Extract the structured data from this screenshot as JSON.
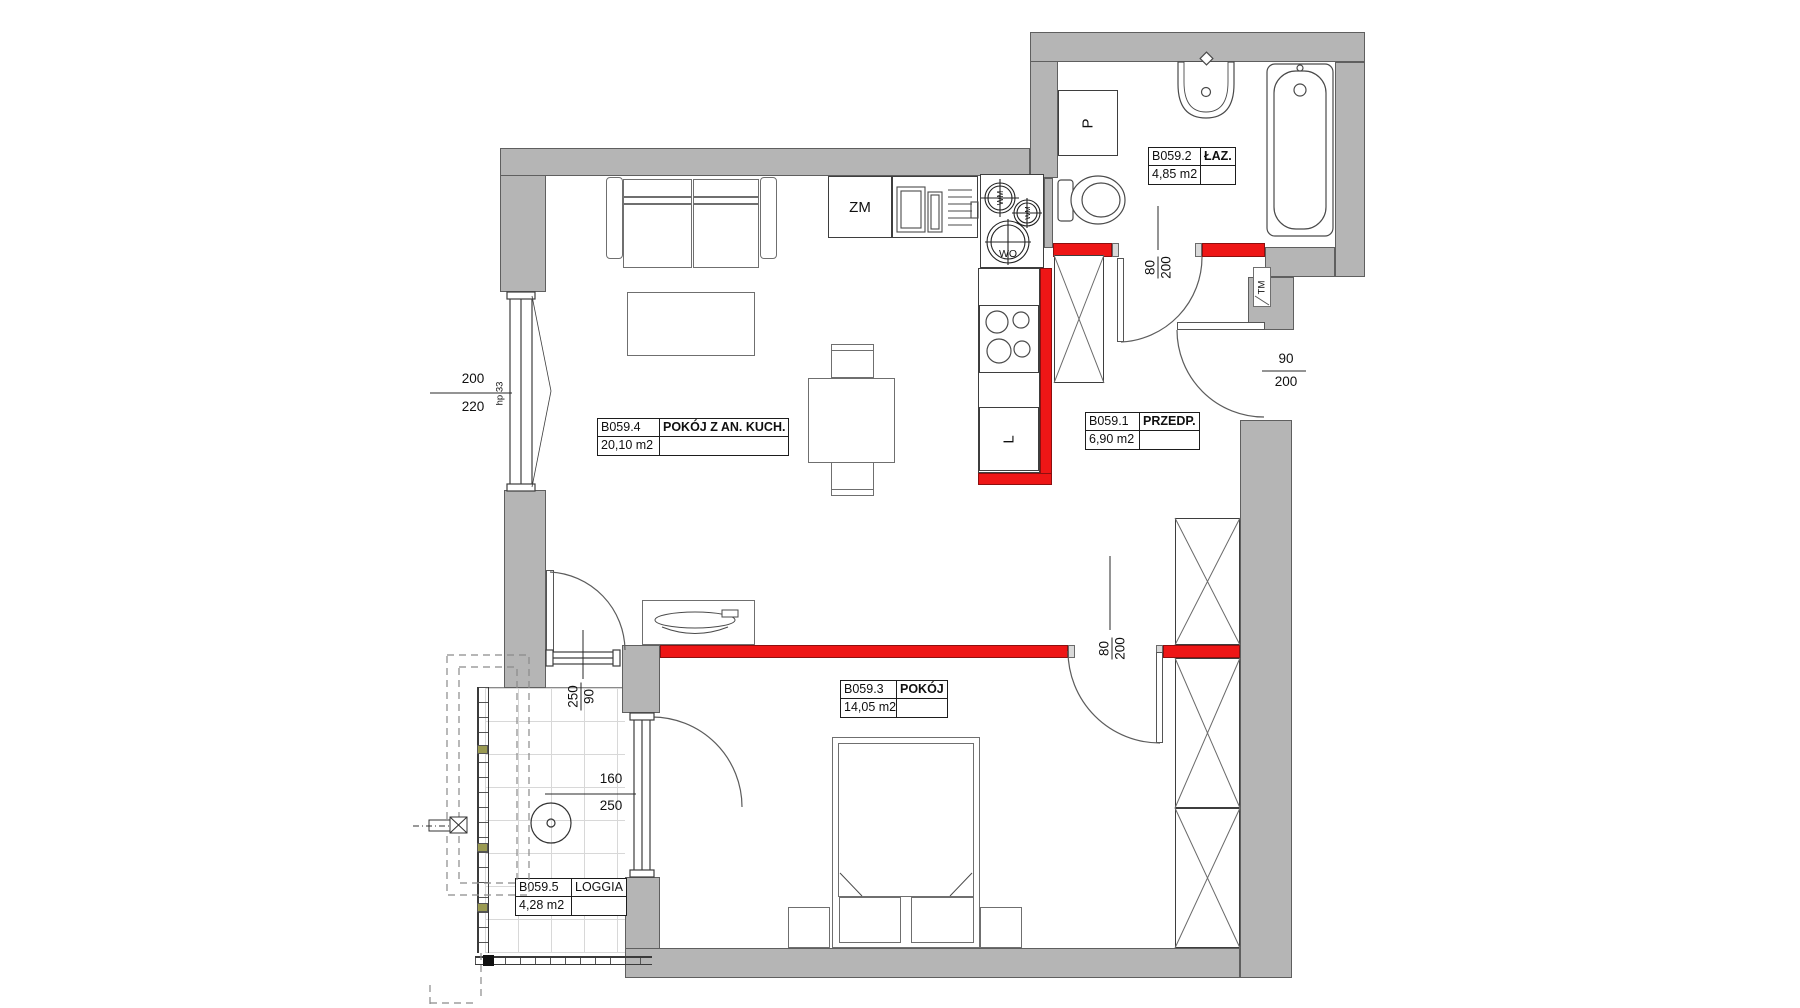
{
  "rooms": [
    {
      "id": "B059.4",
      "name": "POKÓJ Z AN. KUCH.",
      "area": "20,10 m2"
    },
    {
      "id": "B059.2",
      "name": "ŁAZ.",
      "area": "4,85 m2"
    },
    {
      "id": "B059.1",
      "name": "PRZEDP.",
      "area": "6,90 m2"
    },
    {
      "id": "B059.3",
      "name": "POKÓJ",
      "area": "14,05 m2"
    },
    {
      "id": "B059.5",
      "name": "LOGGIA",
      "area": "4,28 m2"
    }
  ],
  "dimensions": {
    "living_window": {
      "a": "200",
      "b": "220"
    },
    "window_sill_note": "hp 33",
    "loggia_door": {
      "a": "250",
      "b": "90"
    },
    "loggia_window": {
      "a": "160",
      "b": "250"
    },
    "bathroom_door": {
      "a": "80",
      "b": "200"
    },
    "entry_door": {
      "a": "90",
      "b": "200"
    },
    "bedroom_door": {
      "a": "80",
      "b": "200"
    }
  },
  "appliances": {
    "dishwasher": "ZM",
    "washing_machine": "P",
    "fridge": "L",
    "meter_box": "TM",
    "shaft_top": "WM",
    "shaft_mid": "WM",
    "shaft_bottom": "WO"
  },
  "colors": {
    "wall": "#b5b5b5",
    "accent_red": "#ee1616"
  }
}
